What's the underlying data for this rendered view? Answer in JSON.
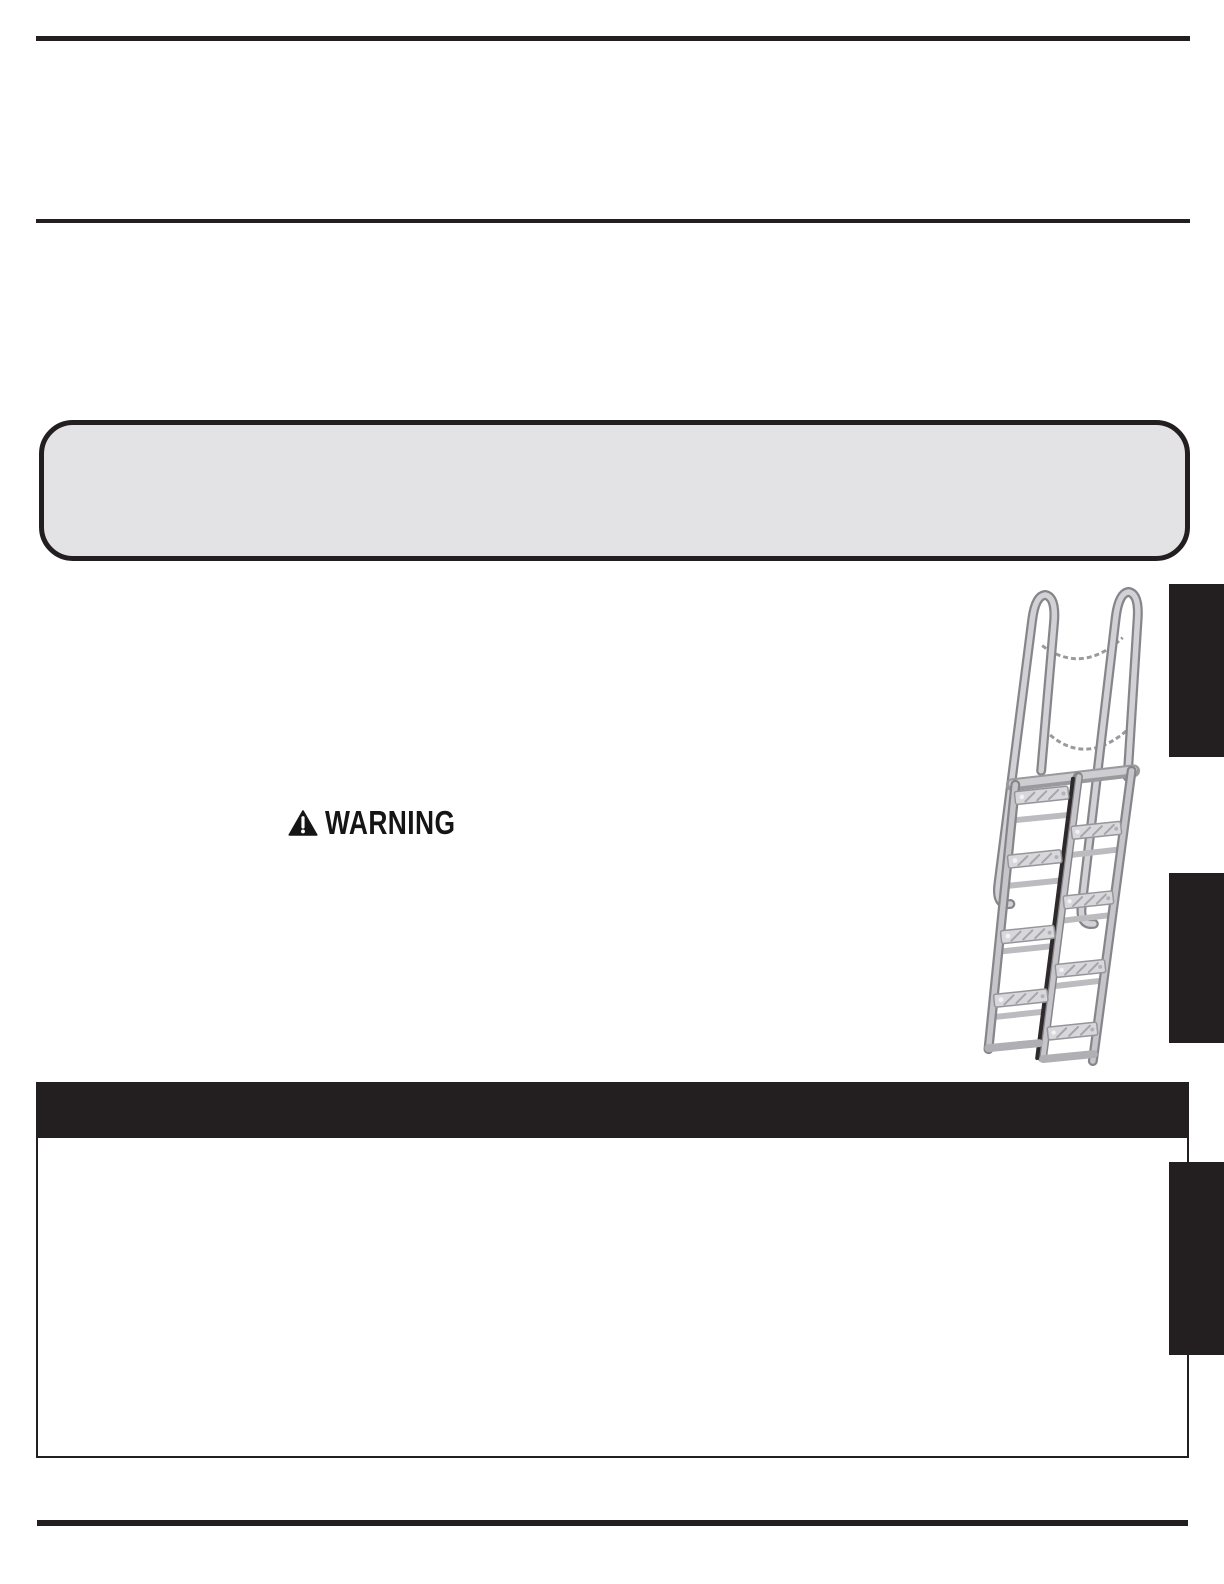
{
  "document": {
    "warning": {
      "label": "WARNING"
    },
    "illustration": {
      "name": "alternating-tread-stair"
    },
    "side_tabs": {
      "count": 3
    },
    "colors": {
      "ink": "#231f20",
      "callout_fill": "#e3e3e5",
      "ladder_light": "#d6d6da",
      "ladder_mid": "#b9b9bd",
      "ladder_outline": "#86868a",
      "ladder_gap": "#2e2a2b"
    }
  }
}
